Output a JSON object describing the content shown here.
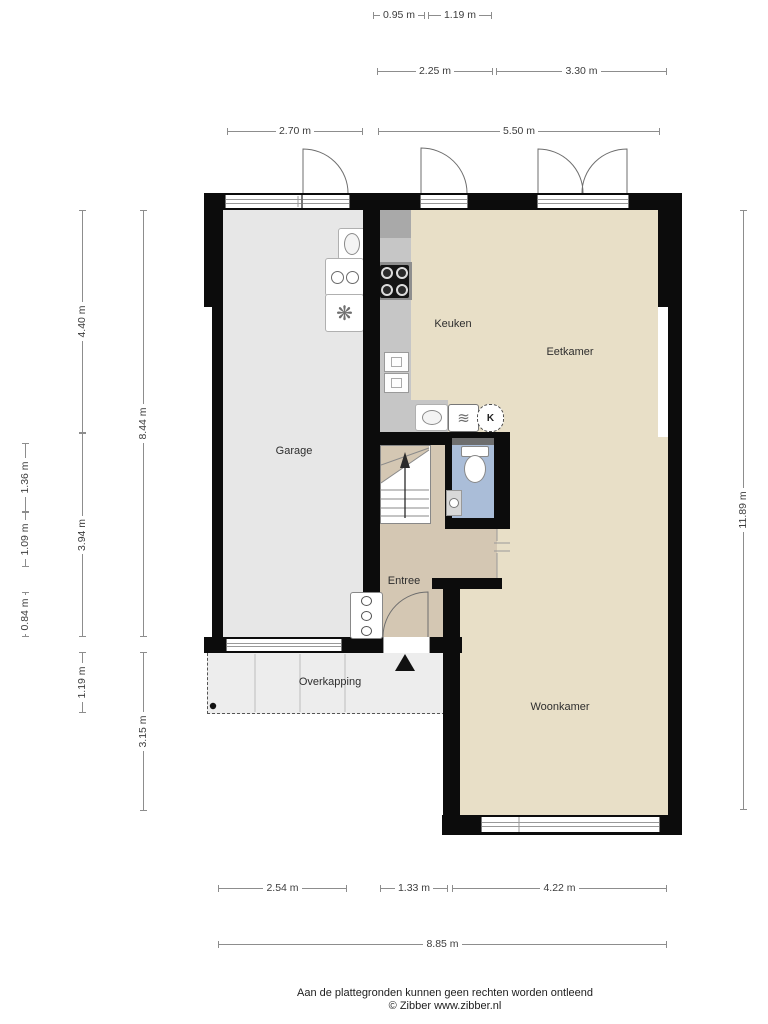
{
  "rooms": {
    "garage": "Garage",
    "keuken": "Keuken",
    "eetkamer": "Eetkamer",
    "entree": "Entree",
    "woonkamer": "Woonkamer",
    "overkapping": "Overkapping",
    "boiler": "K"
  },
  "footer": {
    "line1": "Aan de plattegronden kunnen geen rechten worden ontleend",
    "line2": "© Zibber www.zibber.nl"
  },
  "colors": {
    "wall": "#0c0c0c",
    "room_beige": "#e8dfc7",
    "garage_gray": "#e7e7e7",
    "entree_tan": "#d4c7b3",
    "toilet_blue": "#aabdd8",
    "counter_gray": "#c6c6c6",
    "overkapping_gray": "#ededed",
    "dimension_line": "#8d8d8d"
  },
  "dimensions": [
    {
      "label": "0.95 m",
      "o": "h",
      "x": 373,
      "y": 15,
      "len": 52
    },
    {
      "label": "1.19 m",
      "o": "h",
      "x": 428,
      "y": 15,
      "len": 64
    },
    {
      "label": "2.25 m",
      "o": "h",
      "x": 377,
      "y": 71,
      "len": 116
    },
    {
      "label": "3.30 m",
      "o": "h",
      "x": 496,
      "y": 71,
      "len": 171
    },
    {
      "label": "2.70 m",
      "o": "h",
      "x": 227,
      "y": 131,
      "len": 136
    },
    {
      "label": "5.50 m",
      "o": "h",
      "x": 378,
      "y": 131,
      "len": 282
    },
    {
      "label": "2.54 m",
      "o": "h",
      "x": 218,
      "y": 888,
      "len": 129
    },
    {
      "label": "1.33 m",
      "o": "h",
      "x": 380,
      "y": 888,
      "len": 68
    },
    {
      "label": "4.22 m",
      "o": "h",
      "x": 452,
      "y": 888,
      "len": 215
    },
    {
      "label": "8.85 m",
      "o": "h",
      "x": 218,
      "y": 944,
      "len": 449
    },
    {
      "label": "1.36 m",
      "o": "v",
      "x": 25,
      "y": 443,
      "len": 69
    },
    {
      "label": "1.09 m",
      "o": "v",
      "x": 25,
      "y": 512,
      "len": 55
    },
    {
      "label": "0.84 m",
      "o": "v",
      "x": 25,
      "y": 592,
      "len": 45
    },
    {
      "label": "4.40 m",
      "o": "v",
      "x": 82,
      "y": 210,
      "len": 223
    },
    {
      "label": "3.94 m",
      "o": "v",
      "x": 82,
      "y": 433,
      "len": 204
    },
    {
      "label": "1.19 m",
      "o": "v",
      "x": 82,
      "y": 652,
      "len": 61
    },
    {
      "label": "8.44 m",
      "o": "v",
      "x": 143,
      "y": 210,
      "len": 427
    },
    {
      "label": "3.15 m",
      "o": "v",
      "x": 143,
      "y": 652,
      "len": 159
    },
    {
      "label": "11.89 m",
      "o": "v",
      "x": 743,
      "y": 210,
      "len": 600
    }
  ]
}
